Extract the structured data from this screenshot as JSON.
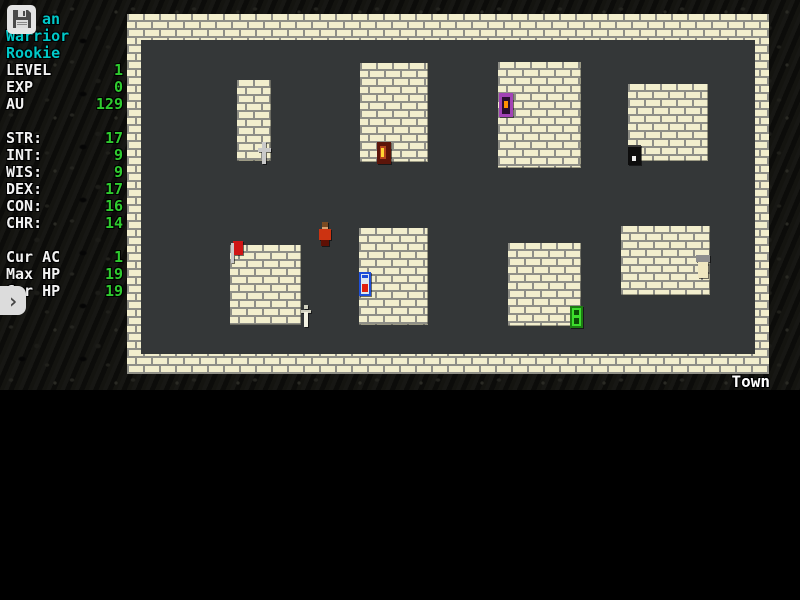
{
  "hud": {
    "name_visible": "an",
    "class": "Warrior",
    "rank": "Rookie",
    "top_stats": [
      {
        "label": "LEVEL",
        "value": "1"
      },
      {
        "label": "EXP",
        "value": "0"
      },
      {
        "label": "AU",
        "value": "129"
      }
    ],
    "attributes": [
      {
        "label": "STR:",
        "value": "17"
      },
      {
        "label": "INT:",
        "value": "9"
      },
      {
        "label": "WIS:",
        "value": "9"
      },
      {
        "label": "DEX:",
        "value": "17"
      },
      {
        "label": "CON:",
        "value": "16"
      },
      {
        "label": "CHR:",
        "value": "14"
      }
    ],
    "vitals": [
      {
        "label": "Cur AC",
        "value": "1"
      },
      {
        "label": "Max HP",
        "value": "19"
      },
      {
        "label": "Cur HP",
        "value": "19"
      }
    ],
    "save_icon": "floppy-disk-icon",
    "expand_chevron": "›",
    "colors": {
      "accent_cyan": "#00c8c8",
      "value_green": "#2fcb2f",
      "label_white": "#f2f2f2"
    }
  },
  "map": {
    "location_label": "Town",
    "colors": {
      "brick": "#f2eecd",
      "mortar": "#8f8f87",
      "floor": "#343738"
    },
    "buildings_count": 8,
    "sprites": [
      {
        "name": "silver-cross-sprite"
      },
      {
        "name": "red-torch-door-sprite"
      },
      {
        "name": "purple-door-sprite"
      },
      {
        "name": "black-door-sprite"
      },
      {
        "name": "red-flag-sprite"
      },
      {
        "name": "white-dagger-sprite"
      },
      {
        "name": "player-character-sprite"
      },
      {
        "name": "blue-potion-door-sprite"
      },
      {
        "name": "green-door-sprite"
      },
      {
        "name": "gray-cap-figure-sprite"
      }
    ]
  }
}
